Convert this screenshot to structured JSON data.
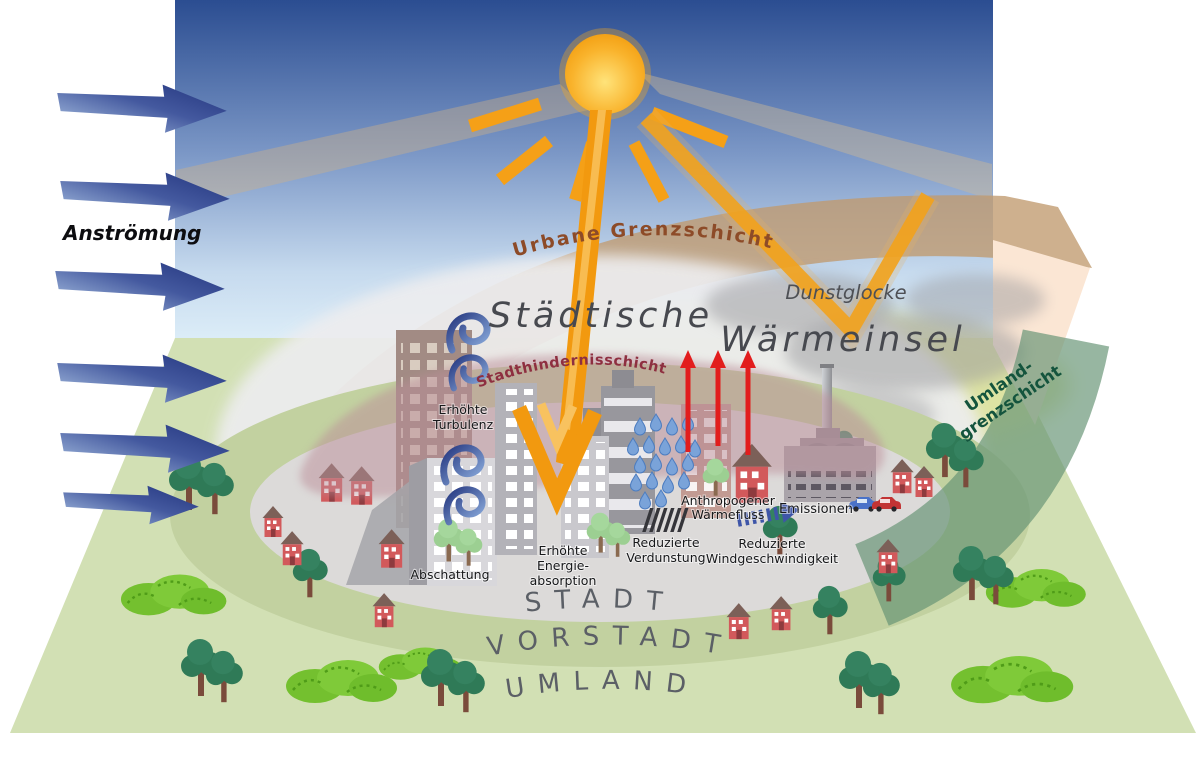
{
  "diagram": {
    "title": {
      "part1": "Städtische",
      "part2": "Wärmeinsel"
    },
    "inflow_label": "Anströmung",
    "layers": {
      "urbane_grenzschicht": "Urbane Grenzschicht",
      "stadthindernisschicht": "Stadthindernisschicht",
      "dunstglocke": "Dunstglocke",
      "umland_grenzschicht_line1": "Umland-",
      "umland_grenzschicht_line2": "grenzschicht"
    },
    "zones": {
      "stadt": "STADT",
      "vorstadt": "VORSTADT",
      "umland": "UMLAND"
    },
    "effects": {
      "turbulenz_line1": "Erhöhte",
      "turbulenz_line2": "Turbulenz",
      "abschattung": "Abschattung",
      "energie_line1": "Erhöhte",
      "energie_line2": "Energie-",
      "energie_line3": "absorption",
      "verdunstung_line1": "Reduzierte",
      "verdunstung_line2": "Verdunstung",
      "waermefluss_line1": "Anthropogener",
      "waermefluss_line2": "Wärmefluss",
      "wind_line1": "Reduzierte",
      "wind_line2": "Windgeschwindigkeit",
      "emissionen": "Emissionen"
    },
    "icons": {
      "sun": "sun-icon",
      "inflow_arrow": "wind-flow-arrow-icon",
      "turbulence": "turbulence-swirl-icon",
      "rain": "rain-drops-icon",
      "heat": "heat-up-arrow-icon",
      "reduced_wind": "dashed-wind-arrow-icon",
      "cars": "car-icon"
    },
    "colors": {
      "sky_top": "#2b4d91",
      "sky_bottom": "#dcedf8",
      "ground_green": "#d2e0b4",
      "vorstadt_green": "#c2d1a0",
      "city_gray": "#dcdad9",
      "urban_boundary_tan": "#c09a6e",
      "umland_boundary_green": "#669474",
      "heat_dome_gray": "#ededef",
      "sun_orange": "#f6a014",
      "ray_orange": "#f2990f",
      "inflow_blue": "#3a4f9b",
      "heat_red": "#e21d1d",
      "label_dark": "#17181a",
      "title_gray": "#47494f",
      "urbane_text_brown": "#8d4b28",
      "stadthindernis_text_red": "#8e2f40",
      "umland_text_green": "#14543d"
    }
  }
}
